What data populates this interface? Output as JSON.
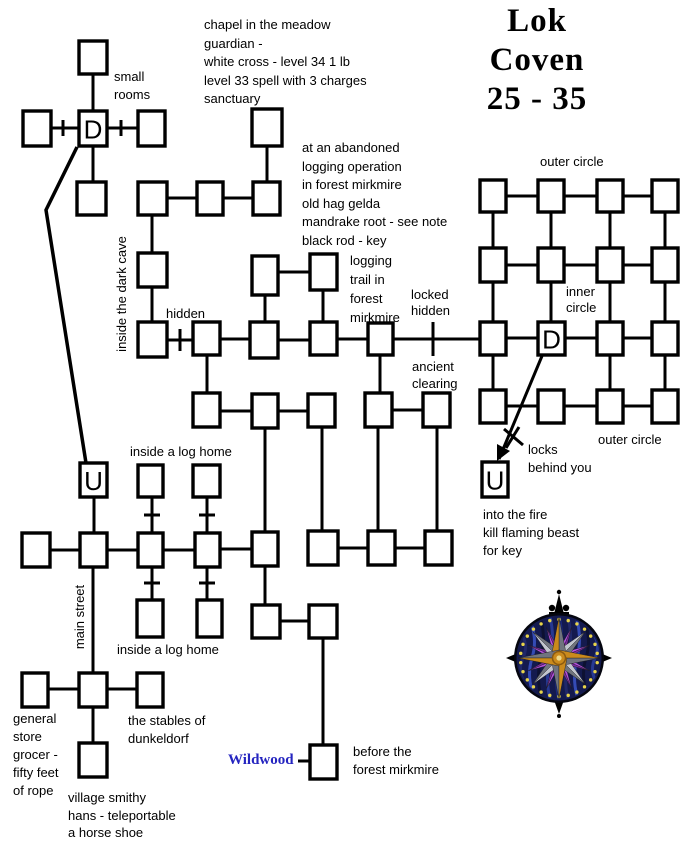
{
  "title": {
    "lines": [
      "Lok",
      "Coven",
      "25 - 35"
    ]
  },
  "colors": {
    "ink": "#000000",
    "wildwood_blue": "#2525c0",
    "compass_rim": "#05060f",
    "compass_sea": "#141a4e",
    "compass_dot": "#e8d44a",
    "compass_silver_light": "#c2c5ce",
    "compass_silver_dark": "#70747e",
    "compass_orange_light": "#ca8a1c",
    "compass_orange_dark": "#8a5a10",
    "compass_purple_light": "#b44fe0",
    "compass_purple_dark": "#7c2aa0"
  },
  "labels": [
    {
      "id": "chapel-note",
      "x": 204,
      "y": 16,
      "lh": 18.5,
      "lines": [
        "chapel in the meadow",
        "guardian -",
        "white cross - level 34  1 lb",
        "level 33  spell with 3 charges",
        "sanctuary"
      ]
    },
    {
      "id": "small-rooms",
      "x": 114,
      "y": 68,
      "lh": 18,
      "lines": [
        "small",
        "rooms"
      ]
    },
    {
      "id": "abandoned-note",
      "x": 302,
      "y": 139,
      "lh": 18.5,
      "lines": [
        "at an abandoned",
        "logging operation",
        "in forest mirkmire",
        "old hag gelda",
        "mandrake root - see note",
        "black rod - key"
      ]
    },
    {
      "id": "outer-circle-top",
      "x": 540,
      "y": 153,
      "lines": [
        "outer circle"
      ]
    },
    {
      "id": "logging-trail",
      "x": 350,
      "y": 251,
      "lh": 19,
      "lines": [
        "logging",
        "trail in",
        "forest",
        "mirkmire"
      ]
    },
    {
      "id": "locked-hidden",
      "x": 411,
      "y": 287,
      "lh": 16,
      "lines": [
        "locked",
        "hidden"
      ]
    },
    {
      "id": "inner-circle",
      "x": 566,
      "y": 284,
      "lh": 16,
      "lines": [
        "inner",
        "circle"
      ]
    },
    {
      "id": "hidden-label",
      "x": 166,
      "y": 305,
      "lines": [
        "hidden"
      ]
    },
    {
      "id": "ancient-clearing",
      "x": 412,
      "y": 358,
      "lh": 17,
      "lines": [
        "ancient",
        "clearing"
      ]
    },
    {
      "id": "outer-circle-bottom",
      "x": 598,
      "y": 431,
      "lines": [
        "outer circle"
      ]
    },
    {
      "id": "locks-behind-you",
      "x": 528,
      "y": 441,
      "lh": 18,
      "lines": [
        "locks",
        "behind you"
      ]
    },
    {
      "id": "inside-log-home-upper",
      "x": 130,
      "y": 443,
      "lines": [
        "inside a log home"
      ]
    },
    {
      "id": "into-the-fire",
      "x": 483,
      "y": 506,
      "lh": 18,
      "lines": [
        "into the fire",
        "kill flaming beast",
        "for key"
      ]
    },
    {
      "id": "inside-log-home-lower",
      "x": 117,
      "y": 641,
      "lines": [
        "inside a log home"
      ]
    },
    {
      "id": "general-store",
      "x": 13,
      "y": 710,
      "lh": 18,
      "lines": [
        "general",
        "store",
        "grocer -",
        "fifty feet",
        "of rope"
      ]
    },
    {
      "id": "stables",
      "x": 128,
      "y": 712,
      "lh": 18,
      "lines": [
        "the stables of",
        "dunkeldorf"
      ]
    },
    {
      "id": "before-forest",
      "x": 353,
      "y": 743,
      "lh": 18,
      "lines": [
        "before the",
        "forest mirkmire"
      ]
    },
    {
      "id": "village-smithy",
      "x": 68,
      "y": 789,
      "lh": 17.5,
      "lines": [
        "village smithy",
        "hans - teleportable",
        "a horse shoe"
      ]
    },
    {
      "id": "wildwood",
      "x": 228,
      "y": 751,
      "serif": true,
      "bold": true,
      "size": 15,
      "color": "#2525c0",
      "lines": [
        "Wildwood"
      ]
    },
    {
      "id": "inside-dark-cave",
      "x": 122,
      "y": 294,
      "rotate": -90,
      "width": 140,
      "lines": [
        "inside the dark cave"
      ]
    },
    {
      "id": "main-street",
      "x": 80,
      "y": 617,
      "rotate": -90,
      "width": 92,
      "lines": [
        "main street"
      ]
    }
  ],
  "rooms": [
    {
      "id": "sr-top",
      "x": 79,
      "y": 41,
      "w": 28,
      "h": 33
    },
    {
      "id": "sr-left",
      "x": 23,
      "y": 111,
      "w": 28,
      "h": 35
    },
    {
      "id": "sr-d",
      "x": 79,
      "y": 111,
      "w": 28,
      "h": 35,
      "letter": "D"
    },
    {
      "id": "sr-right",
      "x": 138,
      "y": 111,
      "w": 27,
      "h": 35
    },
    {
      "id": "sr-bottom",
      "x": 77,
      "y": 182,
      "w": 29,
      "h": 33
    },
    {
      "id": "chapel",
      "x": 252,
      "y": 109,
      "w": 30,
      "h": 37
    },
    {
      "id": "lg-1",
      "x": 138,
      "y": 182,
      "w": 29,
      "h": 33
    },
    {
      "id": "lg-2",
      "x": 197,
      "y": 182,
      "w": 26,
      "h": 33
    },
    {
      "id": "lg-3",
      "x": 253,
      "y": 182,
      "w": 27,
      "h": 33
    },
    {
      "id": "cave-1",
      "x": 138,
      "y": 253,
      "w": 29,
      "h": 34
    },
    {
      "id": "log-a",
      "x": 252,
      "y": 256,
      "w": 26,
      "h": 39
    },
    {
      "id": "log-b",
      "x": 310,
      "y": 254,
      "w": 27,
      "h": 36
    },
    {
      "id": "hid-1",
      "x": 138,
      "y": 322,
      "w": 29,
      "h": 35
    },
    {
      "id": "hid-2",
      "x": 193,
      "y": 322,
      "w": 27,
      "h": 33
    },
    {
      "id": "hid-3",
      "x": 250,
      "y": 322,
      "w": 28,
      "h": 36
    },
    {
      "id": "hid-4",
      "x": 310,
      "y": 322,
      "w": 27,
      "h": 33
    },
    {
      "id": "hid-5",
      "x": 368,
      "y": 323,
      "w": 25,
      "h": 32
    },
    {
      "id": "anc-1",
      "x": 193,
      "y": 393,
      "w": 27,
      "h": 34
    },
    {
      "id": "anc-2",
      "x": 252,
      "y": 394,
      "w": 26,
      "h": 34
    },
    {
      "id": "anc-3",
      "x": 308,
      "y": 394,
      "w": 27,
      "h": 33
    },
    {
      "id": "anc-4",
      "x": 365,
      "y": 393,
      "w": 27,
      "h": 34
    },
    {
      "id": "anc-5",
      "x": 423,
      "y": 393,
      "w": 27,
      "h": 34
    },
    {
      "id": "u-west",
      "x": 80,
      "y": 463,
      "w": 27,
      "h": 34,
      "letter": "U"
    },
    {
      "id": "lh-1",
      "x": 138,
      "y": 465,
      "w": 25,
      "h": 32
    },
    {
      "id": "lh-2",
      "x": 193,
      "y": 465,
      "w": 27,
      "h": 32
    },
    {
      "id": "st-1",
      "x": 22,
      "y": 533,
      "w": 28,
      "h": 34
    },
    {
      "id": "st-2",
      "x": 80,
      "y": 533,
      "w": 27,
      "h": 34
    },
    {
      "id": "st-3",
      "x": 138,
      "y": 533,
      "w": 25,
      "h": 34
    },
    {
      "id": "st-4",
      "x": 195,
      "y": 533,
      "w": 25,
      "h": 34
    },
    {
      "id": "st-5",
      "x": 252,
      "y": 532,
      "w": 26,
      "h": 34
    },
    {
      "id": "st-6",
      "x": 308,
      "y": 531,
      "w": 30,
      "h": 34
    },
    {
      "id": "st-7",
      "x": 368,
      "y": 531,
      "w": 27,
      "h": 34
    },
    {
      "id": "st-8",
      "x": 425,
      "y": 531,
      "w": 27,
      "h": 34
    },
    {
      "id": "bl-1",
      "x": 137,
      "y": 600,
      "w": 26,
      "h": 37
    },
    {
      "id": "bl-2",
      "x": 197,
      "y": 600,
      "w": 25,
      "h": 37
    },
    {
      "id": "tw-1",
      "x": 252,
      "y": 605,
      "w": 28,
      "h": 33
    },
    {
      "id": "tw-2",
      "x": 309,
      "y": 605,
      "w": 28,
      "h": 33
    },
    {
      "id": "vg-1",
      "x": 22,
      "y": 673,
      "w": 26,
      "h": 34
    },
    {
      "id": "vg-2",
      "x": 79,
      "y": 673,
      "w": 28,
      "h": 34
    },
    {
      "id": "vg-3",
      "x": 137,
      "y": 673,
      "w": 26,
      "h": 34
    },
    {
      "id": "vg-4",
      "x": 79,
      "y": 743,
      "w": 28,
      "h": 34
    },
    {
      "id": "ww",
      "x": 310,
      "y": 745,
      "w": 27,
      "h": 34
    },
    {
      "id": "cg-r1c1",
      "x": 480,
      "y": 180,
      "w": 26,
      "h": 32
    },
    {
      "id": "cg-r1c2",
      "x": 538,
      "y": 180,
      "w": 26,
      "h": 32
    },
    {
      "id": "cg-r1c3",
      "x": 597,
      "y": 180,
      "w": 26,
      "h": 32
    },
    {
      "id": "cg-r1c4",
      "x": 652,
      "y": 180,
      "w": 26,
      "h": 32
    },
    {
      "id": "cg-r2c1",
      "x": 480,
      "y": 248,
      "w": 26,
      "h": 34
    },
    {
      "id": "cg-r2c2",
      "x": 538,
      "y": 248,
      "w": 26,
      "h": 34
    },
    {
      "id": "cg-r2c3",
      "x": 597,
      "y": 248,
      "w": 26,
      "h": 34
    },
    {
      "id": "cg-r2c4",
      "x": 652,
      "y": 248,
      "w": 26,
      "h": 34
    },
    {
      "id": "cg-r3c1",
      "x": 480,
      "y": 322,
      "w": 26,
      "h": 33
    },
    {
      "id": "cg-r3c2",
      "x": 538,
      "y": 322,
      "w": 27,
      "h": 33,
      "letter": "D"
    },
    {
      "id": "cg-r3c3",
      "x": 597,
      "y": 322,
      "w": 26,
      "h": 33
    },
    {
      "id": "cg-r3c4",
      "x": 652,
      "y": 322,
      "w": 26,
      "h": 33
    },
    {
      "id": "cg-r4c1",
      "x": 480,
      "y": 390,
      "w": 26,
      "h": 33
    },
    {
      "id": "cg-r4c2",
      "x": 538,
      "y": 390,
      "w": 26,
      "h": 33
    },
    {
      "id": "cg-r4c3",
      "x": 597,
      "y": 390,
      "w": 26,
      "h": 33
    },
    {
      "id": "cg-r4c4",
      "x": 652,
      "y": 390,
      "w": 26,
      "h": 33
    },
    {
      "id": "u-east",
      "x": 482,
      "y": 462,
      "w": 26,
      "h": 35,
      "letter": "U"
    }
  ],
  "connections": [
    [
      93,
      74,
      93,
      111
    ],
    [
      51,
      128,
      79,
      128
    ],
    [
      107,
      128,
      138,
      128
    ],
    [
      93,
      146,
      93,
      182
    ],
    [
      267,
      146,
      267,
      182
    ],
    [
      167,
      198,
      197,
      198
    ],
    [
      223,
      198,
      253,
      198
    ],
    [
      152,
      215,
      152,
      253
    ],
    [
      152,
      287,
      152,
      322
    ],
    [
      167,
      340,
      193,
      340
    ],
    [
      220,
      339,
      250,
      339
    ],
    [
      278,
      340,
      310,
      340
    ],
    [
      337,
      339,
      368,
      339
    ],
    [
      393,
      339,
      480,
      339
    ],
    [
      278,
      272,
      310,
      272
    ],
    [
      265,
      295,
      265,
      322
    ],
    [
      323,
      290,
      323,
      322
    ],
    [
      207,
      355,
      207,
      393
    ],
    [
      380,
      355,
      380,
      393
    ],
    [
      220,
      411,
      252,
      411
    ],
    [
      278,
      411,
      308,
      411
    ],
    [
      392,
      410,
      423,
      410
    ],
    [
      265,
      428,
      265,
      532
    ],
    [
      322,
      427,
      322,
      531
    ],
    [
      378,
      427,
      378,
      531
    ],
    [
      437,
      427,
      437,
      531
    ],
    [
      94,
      497,
      94,
      533
    ],
    [
      152,
      497,
      152,
      533
    ],
    [
      207,
      497,
      207,
      533
    ],
    [
      50,
      550,
      80,
      550
    ],
    [
      107,
      550,
      138,
      550
    ],
    [
      163,
      550,
      195,
      550
    ],
    [
      220,
      549,
      252,
      549
    ],
    [
      338,
      548,
      368,
      548
    ],
    [
      395,
      548,
      425,
      548
    ],
    [
      152,
      567,
      152,
      600
    ],
    [
      207,
      567,
      207,
      600
    ],
    [
      93,
      567,
      93,
      673
    ],
    [
      265,
      566,
      265,
      605
    ],
    [
      280,
      621,
      309,
      621
    ],
    [
      323,
      638,
      323,
      745
    ],
    [
      48,
      689,
      79,
      689
    ],
    [
      107,
      689,
      137,
      689
    ],
    [
      93,
      707,
      93,
      743
    ],
    [
      298,
      761,
      310,
      761
    ],
    [
      506,
      196,
      538,
      196
    ],
    [
      565,
      196,
      597,
      196
    ],
    [
      623,
      196,
      652,
      196
    ],
    [
      506,
      265,
      538,
      265
    ],
    [
      565,
      265,
      597,
      265
    ],
    [
      623,
      265,
      652,
      265
    ],
    [
      506,
      338,
      538,
      338
    ],
    [
      565,
      338,
      597,
      338
    ],
    [
      623,
      338,
      652,
      338
    ],
    [
      506,
      406,
      538,
      406
    ],
    [
      565,
      406,
      597,
      406
    ],
    [
      623,
      406,
      652,
      406
    ],
    [
      493,
      212,
      493,
      248
    ],
    [
      493,
      282,
      493,
      322
    ],
    [
      493,
      355,
      493,
      390
    ],
    [
      551,
      212,
      551,
      248
    ],
    [
      551,
      282,
      551,
      322
    ],
    [
      610,
      212,
      610,
      248
    ],
    [
      610,
      282,
      610,
      322
    ],
    [
      610,
      355,
      610,
      390
    ],
    [
      665,
      212,
      665,
      248
    ],
    [
      665,
      282,
      665,
      322
    ],
    [
      665,
      355,
      665,
      390
    ]
  ],
  "door_ticks": [
    {
      "x": 63,
      "y": 128,
      "dir": "v",
      "len": 16
    },
    {
      "x": 121,
      "y": 128,
      "dir": "v",
      "len": 16
    },
    {
      "x": 180,
      "y": 340,
      "dir": "v",
      "len": 22
    },
    {
      "x": 433,
      "y": 339,
      "dir": "v",
      "len": 34
    },
    {
      "x": 152,
      "y": 515,
      "dir": "h",
      "len": 16
    },
    {
      "x": 207,
      "y": 515,
      "dir": "h",
      "len": 16
    },
    {
      "x": 152,
      "y": 583,
      "dir": "h",
      "len": 16
    },
    {
      "x": 207,
      "y": 583,
      "dir": "h",
      "len": 16
    }
  ],
  "d_to_u_path": [
    [
      77,
      147
    ],
    [
      46,
      210
    ],
    [
      86,
      463
    ]
  ],
  "locks_arrow": {
    "from": [
      542,
      356
    ],
    "to": [
      499,
      459
    ],
    "cross": [
      [
        504,
        429,
        523,
        445
      ],
      [
        519,
        427,
        506,
        448
      ]
    ],
    "head": [
      [
        497,
        461
      ],
      [
        510,
        451
      ],
      [
        497,
        444
      ]
    ]
  },
  "compass": {
    "cx": 559,
    "cy": 658,
    "r": 44,
    "dots": 26
  }
}
